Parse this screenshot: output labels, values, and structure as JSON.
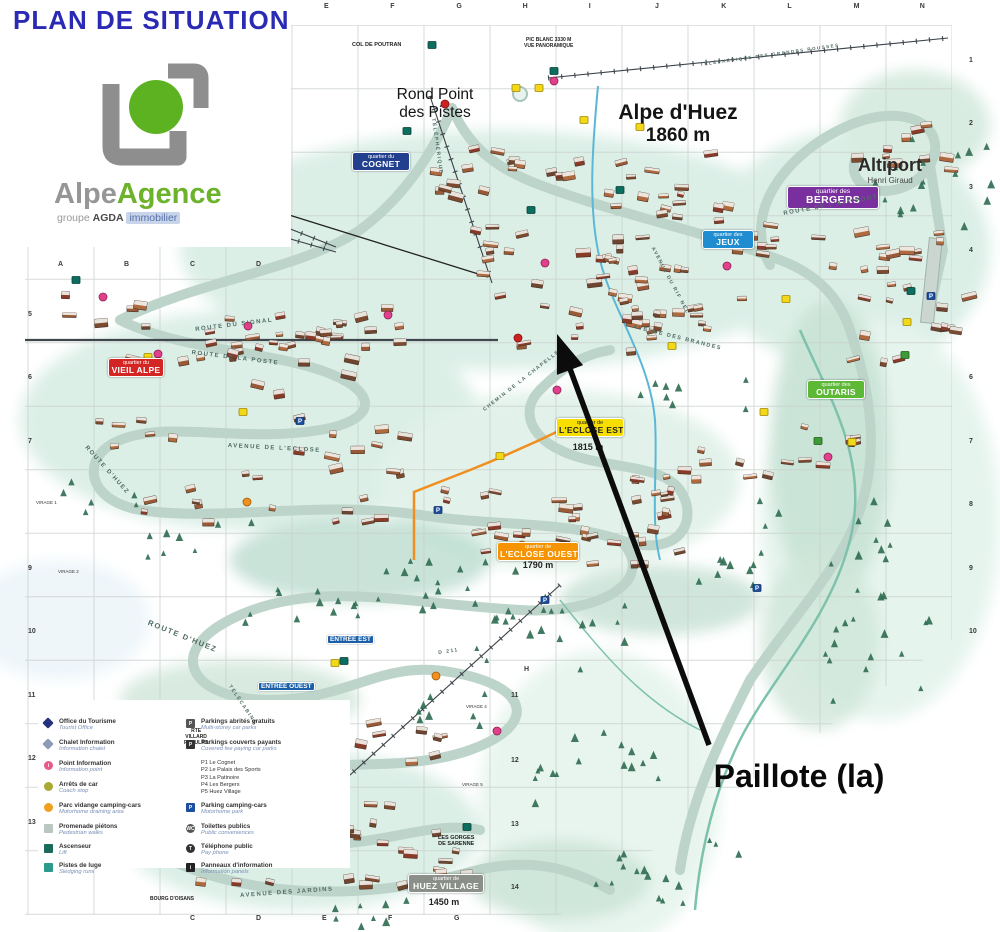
{
  "title": "PLAN DE SITUATION",
  "logo": {
    "alpe": "Alpe",
    "agence": "Agence",
    "groupe": "groupe",
    "agda": "AGDA",
    "immobilier": "immobilier"
  },
  "resort": {
    "name": "Alpe d'Huez",
    "altitude": "1860 m"
  },
  "rond_point": {
    "line1": "Rond Point",
    "line2": "des Pistes"
  },
  "altiport": {
    "name": "Altiport",
    "subtitle": "Henri Giraud"
  },
  "callout": {
    "label": "Paillote (la)"
  },
  "quartiers": [
    {
      "prefix": "quartier du",
      "name": "COGNET",
      "bg": "#23408f",
      "fg": "#ffffff"
    },
    {
      "prefix": "quartier des",
      "name": "JEUX",
      "bg": "#1f8dd0",
      "fg": "#ffffff"
    },
    {
      "prefix": "quartier des",
      "name": "BERGERS",
      "bg": "#7a2f9e",
      "fg": "#ffffff"
    },
    {
      "prefix": "quartier du",
      "name": "VIEIL ALPE",
      "bg": "#d42525",
      "fg": "#ffffff"
    },
    {
      "prefix": "quartier de",
      "name": "L'ECLOSE EST",
      "bg": "#f6df00",
      "fg": "#222222",
      "altitude": "1815 m"
    },
    {
      "prefix": "quartier de",
      "name": "L'ECLOSE OUEST",
      "bg": "#f59300",
      "fg": "#ffffff",
      "altitude": "1790 m"
    },
    {
      "prefix": "quartier des",
      "name": "OUTARIS",
      "bg": "#5cb835",
      "fg": "#ffffff"
    },
    {
      "prefix": "quartier de",
      "name": "HUEZ VILLAGE",
      "bg": "#8a8f8a",
      "fg": "#ffffff",
      "altitude": "1450 m"
    }
  ],
  "entrances": {
    "est": "ENTRÉE EST",
    "ouest": "ENTRÉE OUEST"
  },
  "roads": {
    "signal": "ROUTE DU SIGNAL",
    "poste": "ROUTE DE LA POSTE",
    "eclose": "AVENUE DE L'ECLOSE",
    "huez1": "ROUTE D'HUEZ",
    "huez2": "ROUTE D'HUEZ",
    "jardins": "AVENUE DES JARDINS",
    "altiport": "ROUTE DE L'ALTIPORT",
    "telepherique": "TÉLÉPHÉRIQUE",
    "telecabine": "TÉLÉCABINE",
    "rifnel": "AVENUE DU RIF NEL",
    "brandes": "AVENUE DES BRANDES",
    "chapelle": "CHEMIN DE LA CHAPELLE",
    "grandes_rousses": "TÉLÉPHÉRIQUE DES GRANDES ROUSSES",
    "d211": "D 211"
  },
  "landmarks": {
    "col_de_poutran": "COL DE POUTRAN",
    "pic_blanc_1": "PIC BLANC 3330 M",
    "pic_blanc_2": "VUE PANORAMIQUE",
    "gorges_1": "LES GORGES",
    "gorges_2": "DE SARENNE",
    "villard_1": "RTE",
    "villard_2": "VILLARD",
    "villard_3": "RECULAS",
    "bourg": "BOURG D'OISANS",
    "virage_1": "VIRAGE 1",
    "virage_2": "VIRAGE 2",
    "virage_4": "VIRAGE 4",
    "virage_5": "VIRAGE 5"
  },
  "grid": {
    "top_letters": [
      "E",
      "F",
      "G",
      "H",
      "I",
      "J",
      "K",
      "L",
      "M",
      "N"
    ],
    "left_letters": [
      "A",
      "B",
      "C",
      "D"
    ],
    "bottom_letters": [
      "C",
      "D",
      "E",
      "F",
      "G"
    ],
    "left_numbers": [
      "5",
      "6",
      "7",
      "9",
      "10",
      "11",
      "12",
      "13"
    ],
    "right_numbers": [
      "1",
      "2",
      "3",
      "4",
      "6",
      "7",
      "8",
      "9",
      "10"
    ],
    "inner_numbers": [
      "11",
      "12",
      "13",
      "14"
    ],
    "inner_letter": "H"
  },
  "legend": {
    "left": [
      {
        "fr": "Office du Tourisme",
        "en": "Tourist Office",
        "icon": "tourist-office-icon",
        "shape": "diamond",
        "color": "#24317e"
      },
      {
        "fr": "Chalet Information",
        "en": "Information chalet",
        "icon": "chalet-info-icon",
        "shape": "diamond",
        "color": "#8a9ab8"
      },
      {
        "fr": "Point Information",
        "en": "Information point",
        "icon": "info-point-icon",
        "shape": "circle",
        "color": "#e85a8a",
        "glyph": "i"
      },
      {
        "fr": "Arrêts de car",
        "en": "Coach stop",
        "icon": "coach-stop-icon",
        "shape": "circle",
        "color": "#a8a832"
      },
      {
        "fr": "Parc vidange camping-cars",
        "en": "Motorhome draining area",
        "icon": "motorhome-drain-icon",
        "shape": "circle",
        "color": "#f0a020"
      },
      {
        "fr": "Promenade piétons",
        "en": "Pedestrian walks",
        "icon": "pedestrian-walk-icon",
        "shape": "square",
        "color": "#b8c8c0"
      },
      {
        "fr": "Ascenseur",
        "en": "Lift",
        "icon": "lift-icon",
        "shape": "square",
        "color": "#1a6a5a"
      },
      {
        "fr": "Pistes de luge",
        "en": "Sledging runs",
        "icon": "sledging-icon",
        "shape": "square",
        "color": "#2a9a8a"
      }
    ],
    "right": [
      {
        "fr": "Parkings abrités gratuits",
        "en": "Multi-storey car parks",
        "icon": "free-parking-icon",
        "shape": "square",
        "color": "#555555",
        "glyph": "P"
      },
      {
        "fr": "Parkings couverts payants",
        "en": "Covered fee paying car parks",
        "icon": "paid-parking-icon",
        "shape": "square",
        "color": "#333333",
        "glyph": "P"
      },
      {
        "fr": "Parking camping-cars",
        "en": "Motorhome park",
        "icon": "motorhome-park-icon",
        "shape": "square",
        "color": "#1d4fa0",
        "glyph": "P"
      },
      {
        "fr": "Toilettes publics",
        "en": "Public conveniences",
        "icon": "toilets-icon",
        "shape": "circle",
        "color": "#555555",
        "glyph": "WC"
      },
      {
        "fr": "Téléphone public",
        "en": "Pay phone",
        "icon": "phone-icon",
        "shape": "circle",
        "color": "#333333",
        "glyph": "T"
      },
      {
        "fr": "Panneaux d'information",
        "en": "Information panels",
        "icon": "info-panel-icon",
        "shape": "square",
        "color": "#222222",
        "glyph": "i"
      }
    ],
    "parkings": [
      "P1 Le Cognet",
      "P2 Le Palais des Sports",
      "P3 La Patinoire",
      "P4 Les Bergers",
      "P5 Huez Village"
    ]
  }
}
